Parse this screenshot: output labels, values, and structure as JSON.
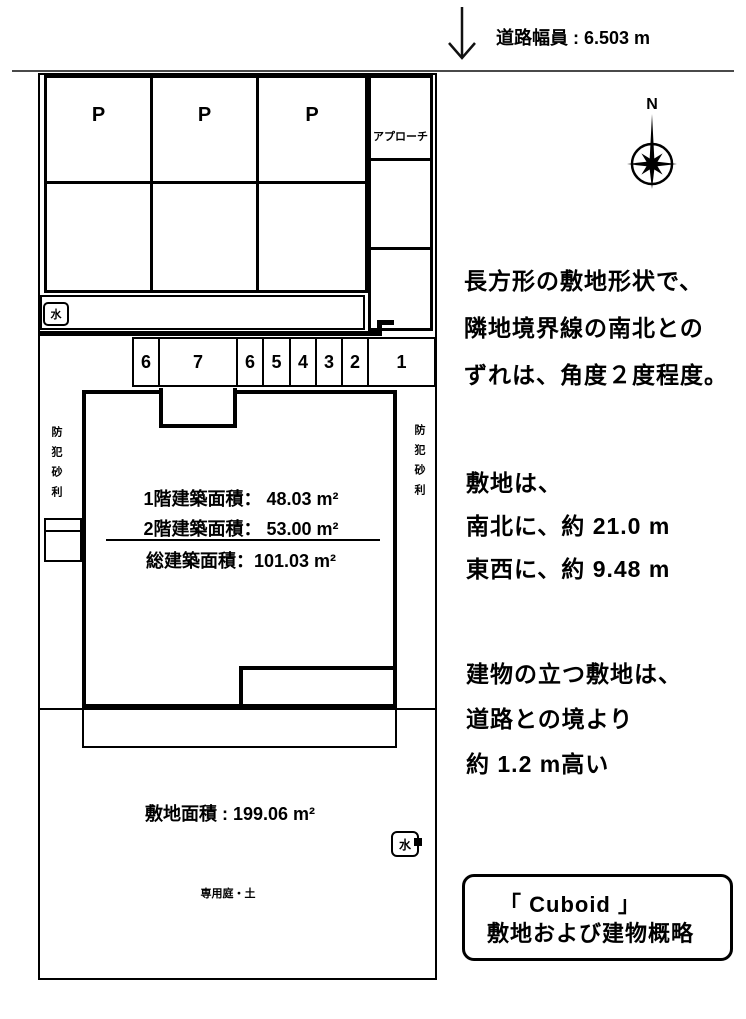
{
  "road": {
    "width_label": "道路幅員 : 6.503 m"
  },
  "compass": {
    "north_label": "N"
  },
  "parking": {
    "stalls": [
      "P",
      "P",
      "P"
    ],
    "approach_label": "アプローチ"
  },
  "water_meter_top": "水",
  "water_meter_bottom": "水",
  "unit_numbers": [
    "6",
    "7",
    "6",
    "5",
    "4",
    "3",
    "2",
    "1"
  ],
  "gravel": {
    "left": "防犯砂利",
    "right": "防犯砂利"
  },
  "building": {
    "floor1_area": "1階建築面積：  48.03 m²",
    "floor2_area": "2階建築面積：  53.00 m²",
    "total_area": "総建築面積：101.03 m²"
  },
  "site": {
    "area_label": "敷地面積 : 199.06 m²",
    "garden_label": "専用庭・土"
  },
  "notes": {
    "shape": [
      "長方形の敷地形状で、",
      "隣地境界線の南北との",
      "ずれは、角度２度程度。"
    ],
    "dimensions": [
      "敷地は、",
      "南北に、約 21.0 m",
      "東西に、約 9.48 m"
    ],
    "elevation": [
      "建物の立つ敷地は、",
      "道路との境より",
      "約 1.2 m高い"
    ]
  },
  "title_box": {
    "line1": "「 Cuboid 」",
    "line2": "敷地および建物概略"
  }
}
